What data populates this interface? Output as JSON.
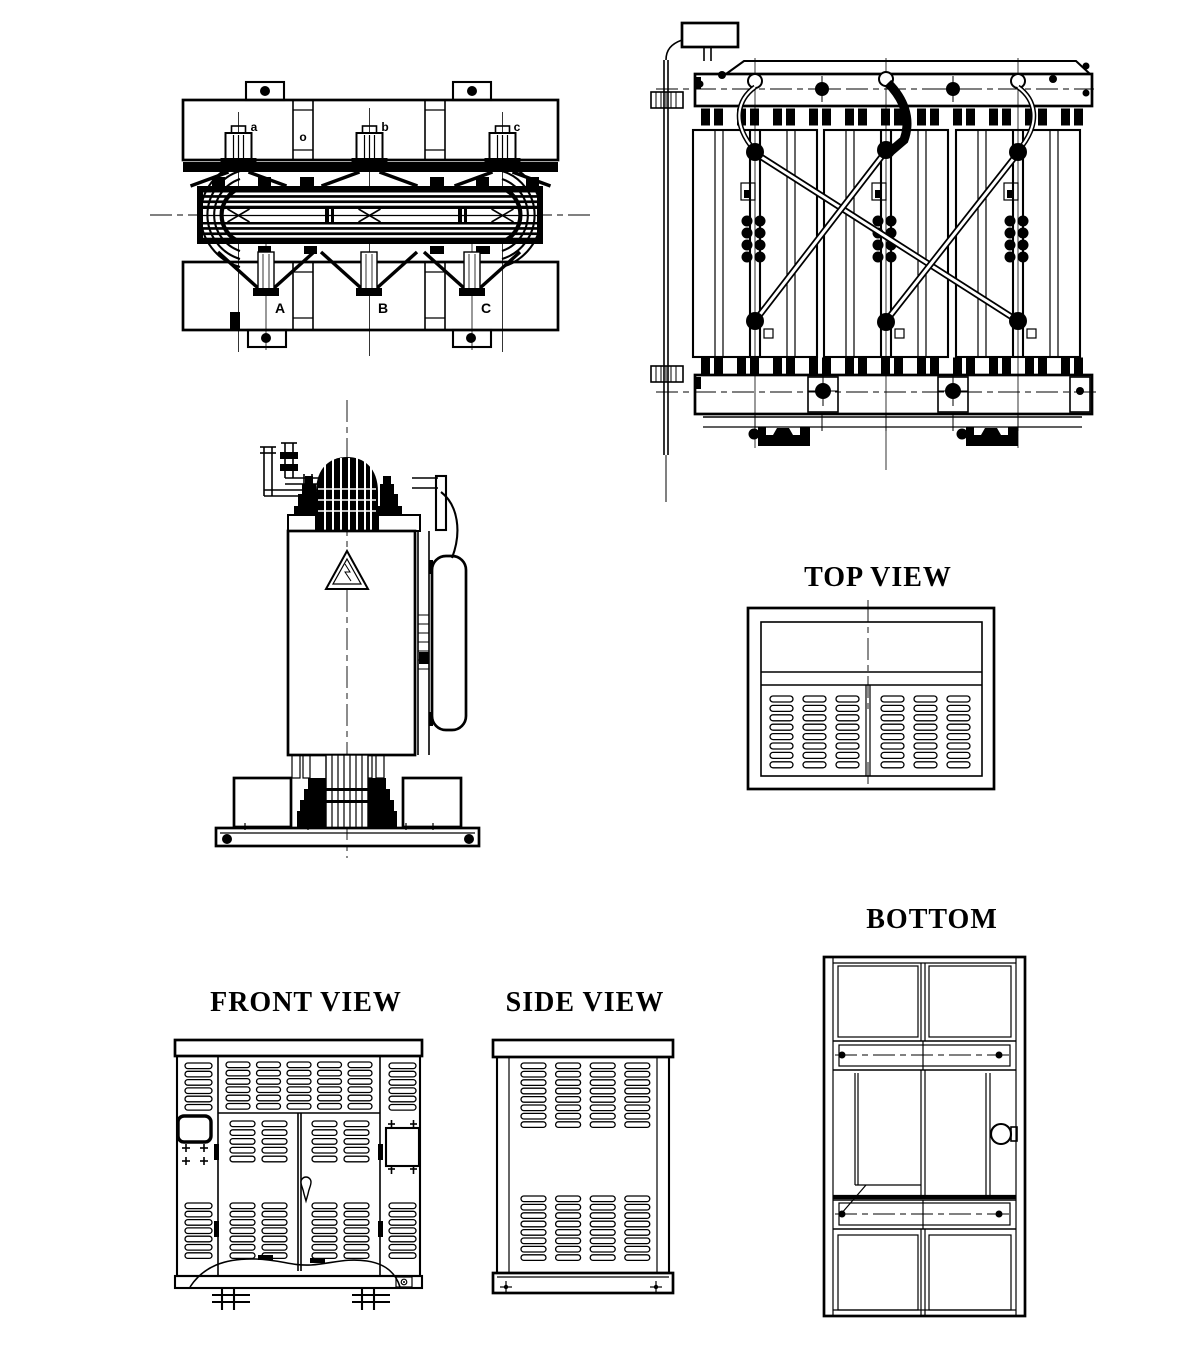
{
  "sheet": {
    "paper_color": "#ffffff",
    "ink_color": "#000000"
  },
  "titles": {
    "enclosure_top": "TOP VIEW",
    "enclosure_bottom": "BOTTOM",
    "enclosure_front": "FRONT VIEW",
    "enclosure_side": "SIDE VIEW"
  },
  "plan_labels": {
    "top": [
      "a",
      "b",
      "c"
    ],
    "center": "o",
    "bottom": [
      "A",
      "B",
      "C"
    ]
  }
}
